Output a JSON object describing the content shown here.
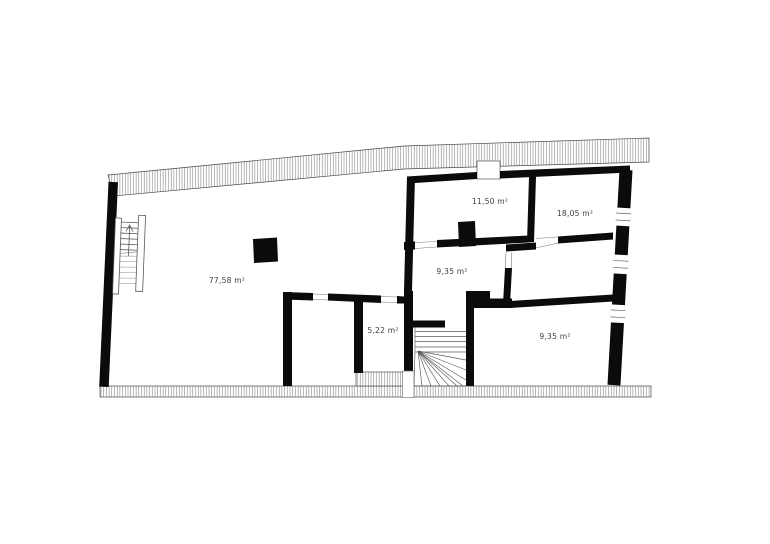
{
  "page": {
    "background": "#ffffff"
  },
  "plan": {
    "unit": "m²",
    "colors": {
      "wall": "#0b0b0b",
      "hatch_line": "#7d7d7d",
      "outline": "#4a4a4a",
      "stair_line": "#5a5a5a",
      "stair_line_light": "#9a9a9a",
      "label": "#3f3f3f",
      "background": "#ffffff"
    },
    "rooms": [
      {
        "id": "room-77-58",
        "area_label": "77,58 m²"
      },
      {
        "id": "room-11-50",
        "area_label": "11,50 m²"
      },
      {
        "id": "room-18-05",
        "area_label": "18,05 m²"
      },
      {
        "id": "room-9-35-middle",
        "area_label": "9,35 m²"
      },
      {
        "id": "room-5-22",
        "area_label": "5,22 m²"
      },
      {
        "id": "room-9-35-bottom",
        "area_label": "9,35 m²"
      }
    ]
  }
}
